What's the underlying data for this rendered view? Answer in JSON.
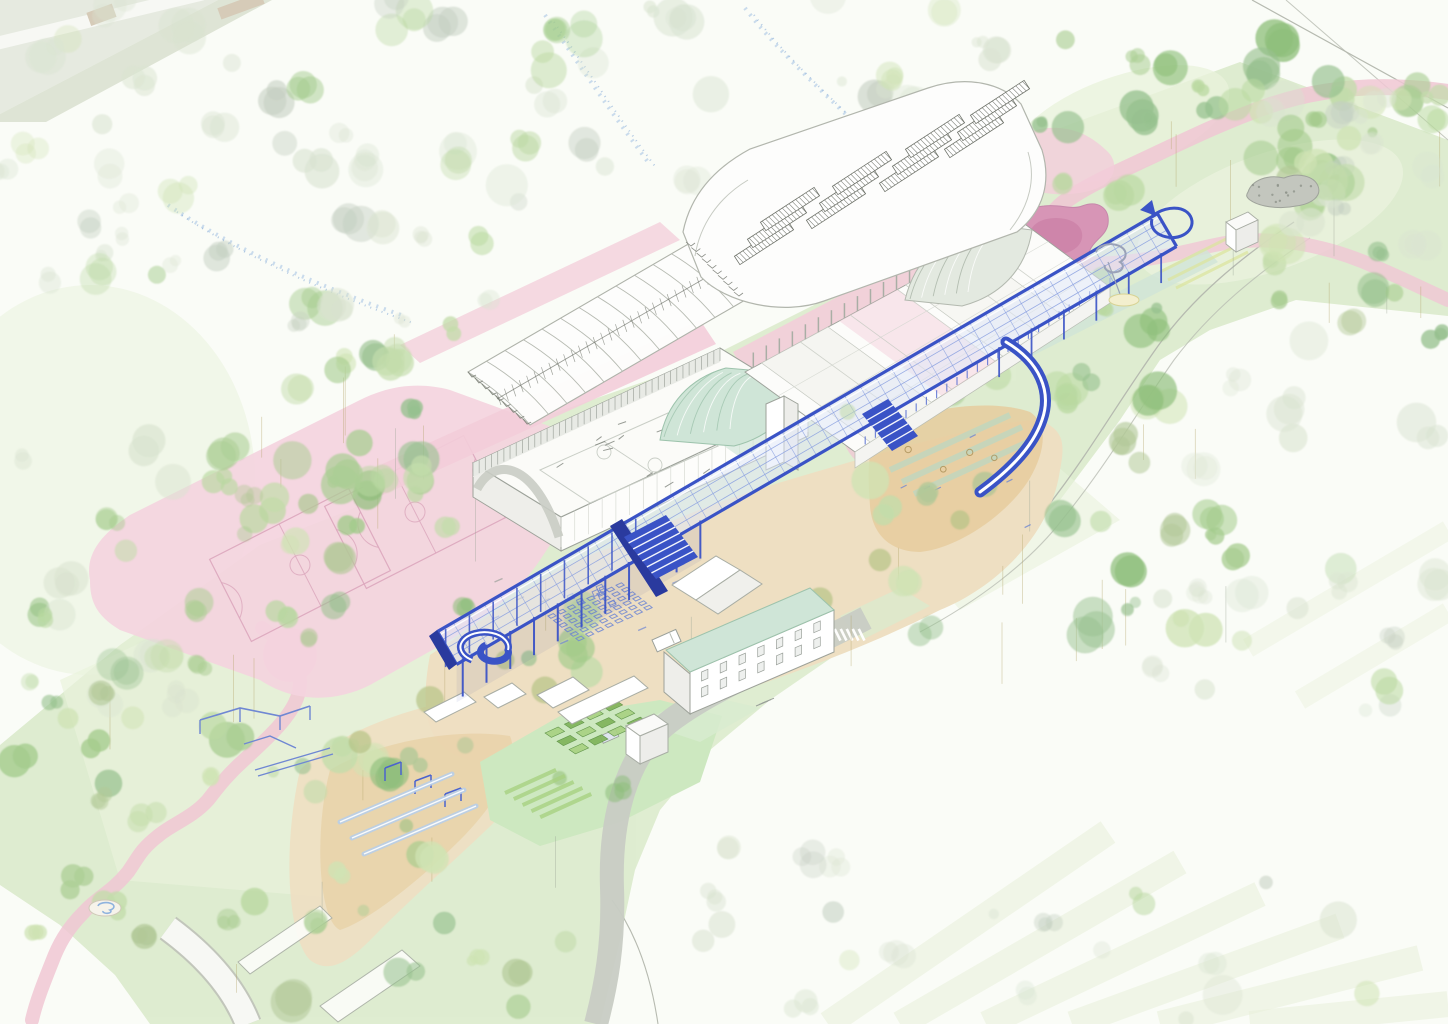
{
  "scene": {
    "kind": "axonometric-landscape-site-plan",
    "features": [
      "park-corridor",
      "scattered-tree-canopies",
      "winding-pink-path",
      "pink-pond",
      "rock-mound",
      "blue-canopy-walkway",
      "canopy-glass-grid",
      "canopy-columns",
      "canopy-stairs",
      "curved-slide-ramp",
      "spiral-ramp",
      "spiral-slide",
      "loop-terminus",
      "sports-hall-cutaway",
      "indoor-court",
      "ribbed-barrel-roof",
      "louvre-barrel-roof",
      "mint-barrel-roof",
      "colonnade-building",
      "basketball-courts",
      "sand-plaza",
      "playground-equipment",
      "chair-grid",
      "benches",
      "community-garden-beds",
      "residential-building-green-roof",
      "sheds-and-pavilions",
      "white-cube-pavilion",
      "roads",
      "crosswalk",
      "fountain",
      "flower-drifts",
      "field-stripes",
      "van",
      "car"
    ]
  },
  "palette": {
    "background": "#fafcf7",
    "field_sage": "#e6eae0",
    "field_sage2": "#dee4d5",
    "tan_building": "#d6cbb8",
    "road_white": "#f7f8f4",
    "road_edge": "#c2c6bb",
    "road_gray": "#c8ccc4",
    "road_line": "#b6bab0",
    "corridor_green": "#dcebcd",
    "lawn_light": "#e8f2da",
    "tree_greens": [
      "#cfe3b4",
      "#b9d8a0",
      "#a3cb8b",
      "#8fbf7c",
      "#abce94",
      "#c3dcab",
      "#b2c897",
      "#97c18f"
    ],
    "tree_faint": "#d9e3d0",
    "tree_gray": "#c4cfc1",
    "olive": "#b7c386",
    "trunk": "#b3a468",
    "pink_path": "#f0c7d4",
    "pink_deep": "#e6a9c0",
    "pond_pink": "#d795b6",
    "pond_core": "#cd82a8",
    "court_pad": "#f4d4de",
    "court_line": "#dba6bc",
    "terrace_pink": "#f3cdd9",
    "sand": "#eedfc2",
    "sand_deep": "#e6cd9e",
    "lawn": "#d8ebcf",
    "garden_lawn": "#cde8c0",
    "bed_green": "#7eb258",
    "bed_light": "#a8d181",
    "mint": "#cfe5d7",
    "mint_line": "#9dc3ac",
    "canopy": "#3a53c6",
    "canopy_dark": "#2a3a9e",
    "canopy_glass": "#e0e8f8",
    "canopy_grid": "#8aa0e0",
    "building_stroke": "#9da29a",
    "building_side": "#eeeeea",
    "building_white": "#ffffff",
    "glazing": "#c9ccc4",
    "hatch": "#6d7168",
    "rock": "#c3c6be",
    "water_blue": "#8fb3de",
    "play_blue": "#6f87d3",
    "landing_yellow": "#f3efce",
    "stripe_field": "#e9f1db"
  }
}
